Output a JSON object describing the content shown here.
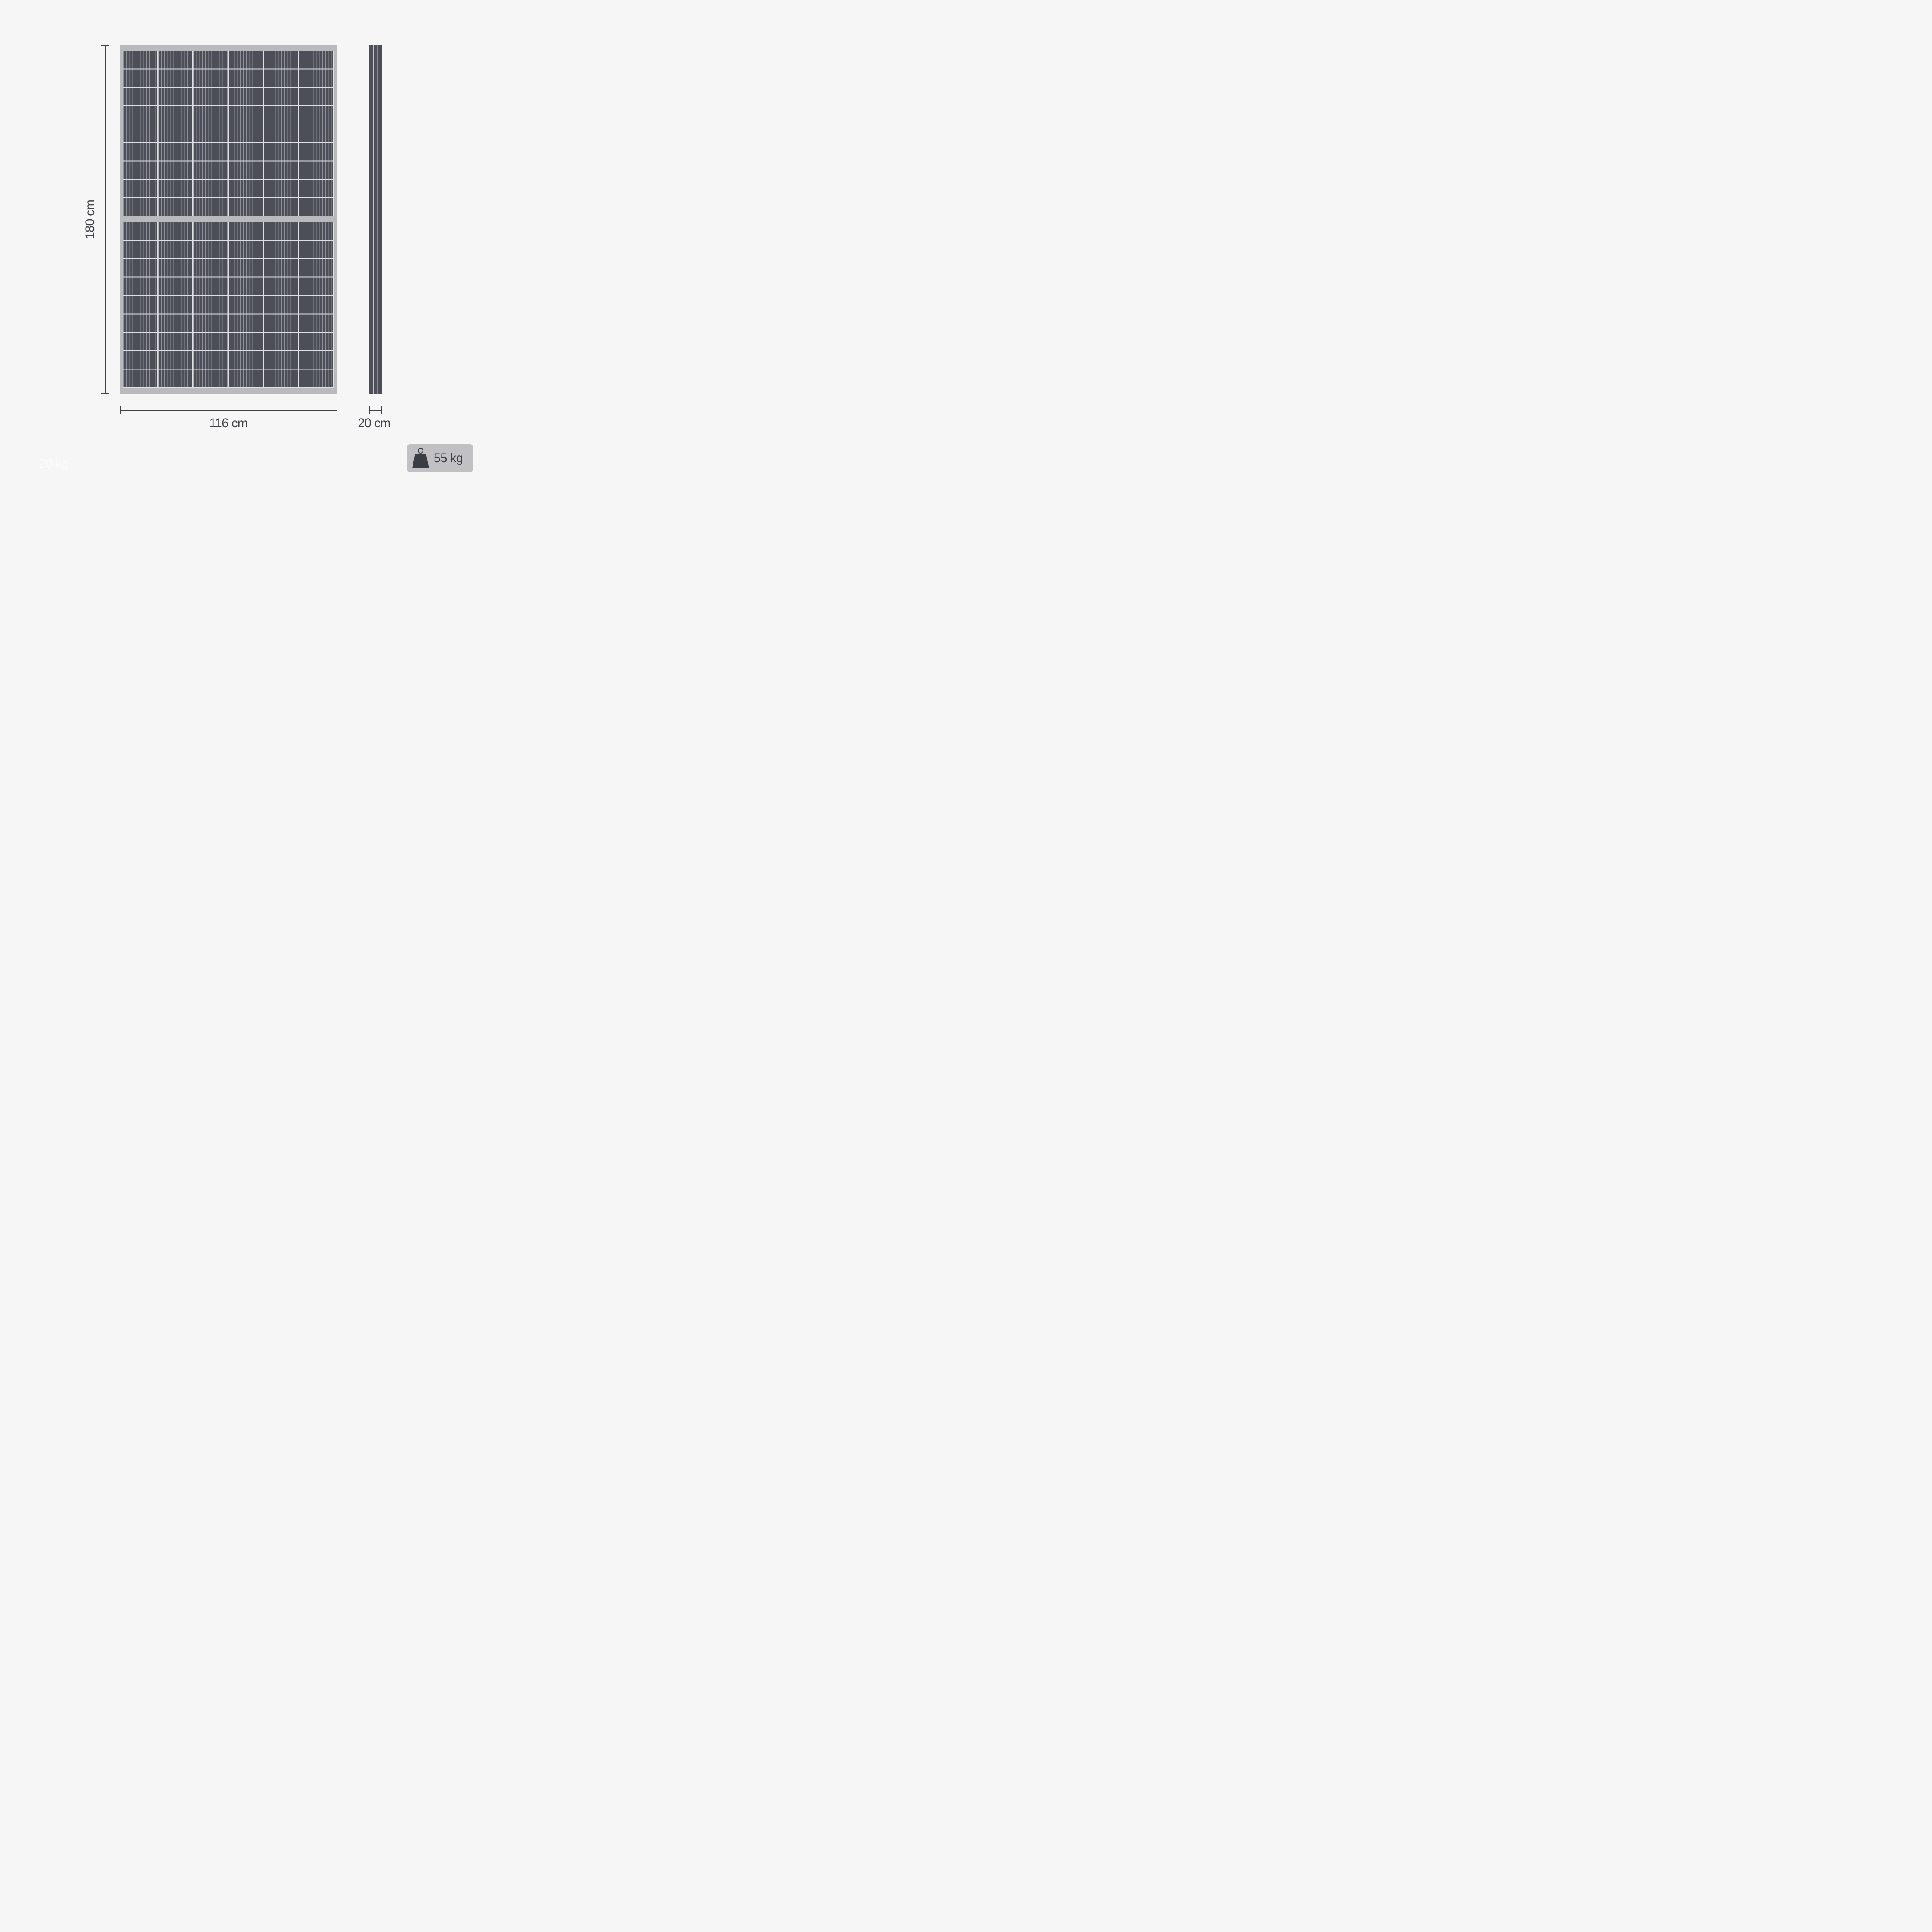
{
  "diagram": {
    "subject": "solar-panel-dimension-diagram",
    "panel": {
      "front_view": {
        "columns": 6,
        "rows_per_half": 9,
        "halves": 2
      },
      "side_view": {
        "stripes": 3
      }
    },
    "dimensions": {
      "height_label": "180 cm",
      "width_label": "116 cm",
      "depth_label": "20 cm"
    },
    "weight_badge": {
      "label": "55 kg",
      "icon": "weight-icon"
    },
    "ghost_weight": {
      "label": "20 kg"
    },
    "colors": {
      "background": "#f6f6f7",
      "frame": "#b9babd",
      "cells": "#4c4f58",
      "grid_line": "#dfe0e4",
      "dimension": "#3e4147",
      "badge_background": "#c1c1c3",
      "badge_foreground": "#3a3d43",
      "ghost_text": "#fdfdfe"
    }
  }
}
